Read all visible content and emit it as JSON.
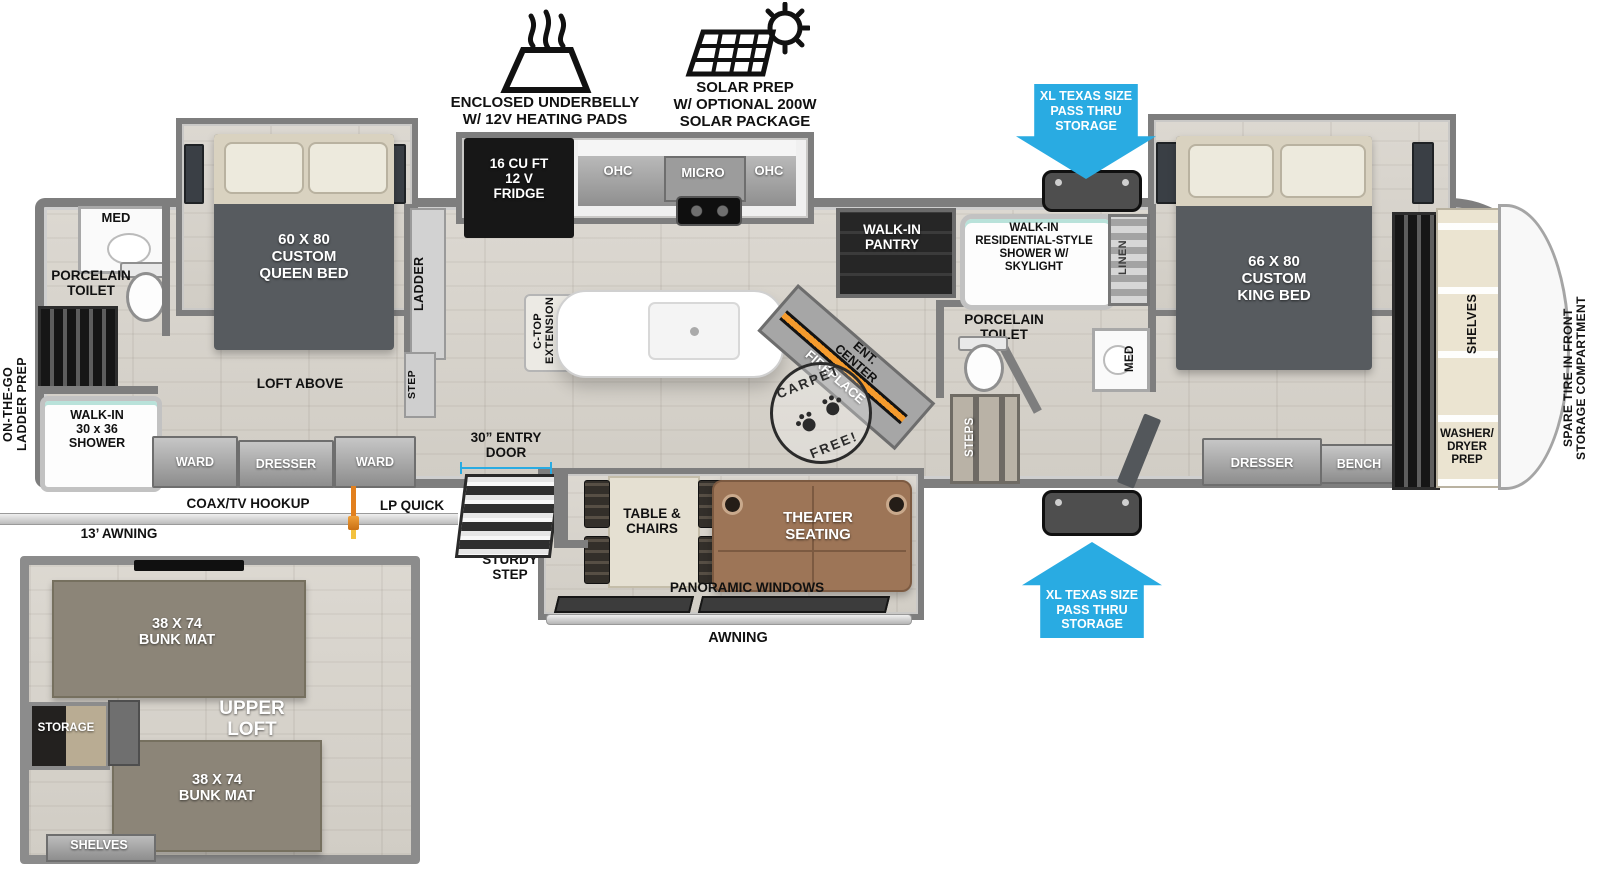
{
  "colors": {
    "arrow_blue": "#29abe2",
    "bed_dark": "#575b5f",
    "sofa_brown": "#9d7557",
    "bunk_mat": "#8c8578",
    "fireplace_glow": "#f59b2d"
  },
  "top_features": {
    "underbelly_label": "ENCLOSED UNDERBELLY\nW/ 12V HEATING PADS",
    "solar_label": "SOLAR PREP\nW/ OPTIONAL 200W\nSOLAR PACKAGE"
  },
  "pass_thru": {
    "top_label": "XL TEXAS SIZE\nPASS THRU\nSTORAGE",
    "bottom_label": "XL TEXAS SIZE\nPASS THRU\nSTORAGE"
  },
  "exterior": {
    "ladder_prep": "ON-THE-GO\nLADDER PREP",
    "coax": "COAX/TV HOOKUP",
    "lp_quick_connect": "LP QUICK\nCONNECT",
    "awning_13": "13’ AWNING",
    "awning_main": "AWNING",
    "spare_tire": "SPARE TIRE IN FRONT\nSTORAGE COMPARTMENT"
  },
  "rear_bath": {
    "med": "MED",
    "toilet": "PORCELAIN\nTOILET",
    "shower": "WALK-IN\n30 x 36\nSHOWER"
  },
  "rear_bedroom": {
    "bed": "60 X  80\nCUSTOM\nQUEEN BED",
    "loft_above": "LOFT ABOVE",
    "ladder": "LADDER",
    "step": "STEP",
    "ward_left": "WARD",
    "dresser": "DRESSER",
    "ward_right": "WARD"
  },
  "kitchen": {
    "fridge": "16 CU FT\n12 V\nFRIDGE",
    "ohc_left": "OHC",
    "micro": "MICRO",
    "ohc_right": "OHC",
    "ctop_extension": "C-TOP\nEXTENSION",
    "pantry": "WALK-IN\nPANTRY",
    "ent_center": "ENT.\nCENTER",
    "fireplace": "FIREPLACE",
    "carpet_free_top": "CARPET",
    "carpet_free_bottom": "FREE!"
  },
  "mid_bath": {
    "shower": "WALK-IN\nRESIDENTIAL-STYLE\nSHOWER W/\nSKYLIGHT",
    "linen": "LINEN",
    "toilet": "PORCELAIN\nTOILET",
    "med": "MED",
    "steps": "STEPS"
  },
  "front_bedroom": {
    "bed": "66 X  80\nCUSTOM\nKING BED",
    "dresser": "DRESSER",
    "bench": "BENCH",
    "shelves": "SHELVES",
    "washer_dryer": "WASHER/\nDRYER\nPREP"
  },
  "living": {
    "entry_door": "30” ENTRY\nDOOR",
    "sturdy_step": "STURDY\nSTEP",
    "table_chairs": "TABLE &\nCHAIRS",
    "theater": "THEATER\nSEATING",
    "panoramic": "PANORAMIC WINDOWS"
  },
  "loft_inset": {
    "bunk_top": "38 X 74\nBUNK MAT",
    "bunk_bottom": "38 X 74\nBUNK MAT",
    "upper_loft": "UPPER\nLOFT",
    "storage": "STORAGE",
    "shelves": "SHELVES"
  }
}
